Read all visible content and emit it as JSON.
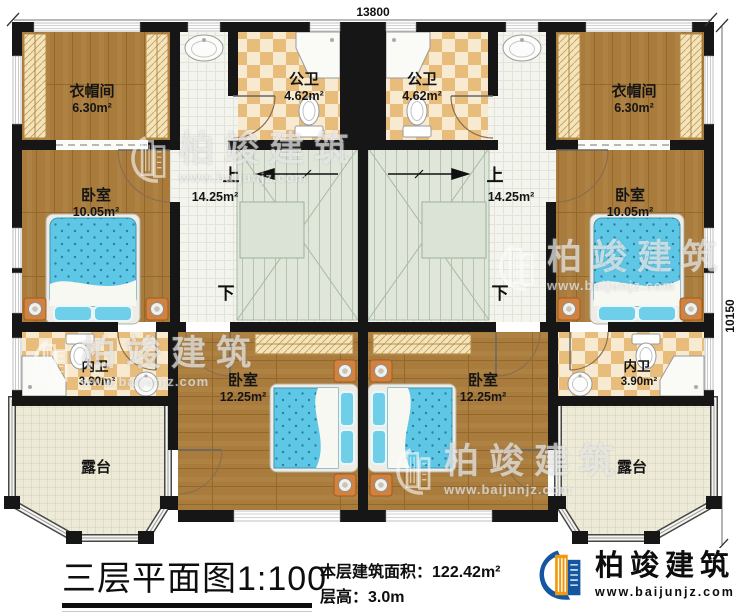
{
  "plan": {
    "dimensions": {
      "top": "13800",
      "right": "10150"
    },
    "rooms": {
      "cloakroom": {
        "name": "衣帽间",
        "area": "6.30m²"
      },
      "public_bath": {
        "name": "公卫",
        "area": "4.62m²"
      },
      "stair_hall": {
        "up": "上",
        "down": "下",
        "area": "14.25m²"
      },
      "bedroom_upper": {
        "name": "卧室",
        "area": "10.05m²"
      },
      "ensuite_bath": {
        "name": "内卫",
        "area": "3.90m²"
      },
      "bedroom_lower": {
        "name": "卧室",
        "area": "12.25m²"
      },
      "terrace": {
        "name": "露台"
      }
    }
  },
  "title_block": {
    "title": "三层平面图",
    "scale": "1:100",
    "area_label": "本层建筑面积：",
    "area_value": "122.42m²",
    "height_label": "层高：",
    "height_value": "3.0m"
  },
  "branding": {
    "company": "柏竣建筑",
    "website": "www.baijunjz.com"
  },
  "watermark": {
    "company": "柏竣建筑",
    "website": "www.baijunjz.com"
  },
  "colors": {
    "wall": "#161616",
    "wood_floor": "#a97c3e",
    "bath_tile": "#e8bc7a",
    "stair": "#e0e7da",
    "bed": "#5ec7e6",
    "terrace": "#edebd8",
    "logo_blue": "#1456a0",
    "logo_orange": "#f2990f"
  }
}
